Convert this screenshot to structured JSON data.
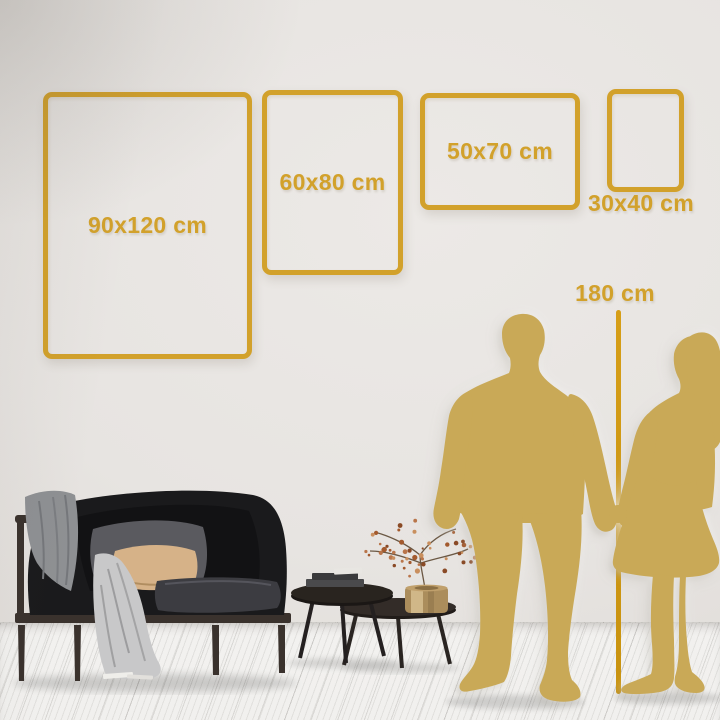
{
  "title": "Wall art size comparison scene",
  "frames": [
    {
      "label": "90x120 cm",
      "width_cm": 90,
      "height_cm": 120
    },
    {
      "label": "60x80 cm",
      "width_cm": 60,
      "height_cm": 80
    },
    {
      "label": "50x70 cm",
      "width_cm": 50,
      "height_cm": 70
    },
    {
      "label": "30x40 cm",
      "width_cm": 30,
      "height_cm": 40
    }
  ],
  "height_marker": {
    "label": "180 cm",
    "value_cm": 180
  },
  "colors": {
    "gold": "#d2a12b",
    "gold_bright": "#d69e17",
    "silhouette": "#c9a957",
    "wall": "#e7e4e1",
    "floor": "#f1f0ee",
    "sofa_dark": "#1a1a1c",
    "wood_dark": "#3a322d",
    "pillow_gray": "#5a5a5f",
    "pillow_beige": "#d6b288",
    "blanket_light": "#c8c8c9",
    "blanket_gray": "#8e9093",
    "brass": "#c0a06c",
    "blossom": "#a35a2e"
  }
}
